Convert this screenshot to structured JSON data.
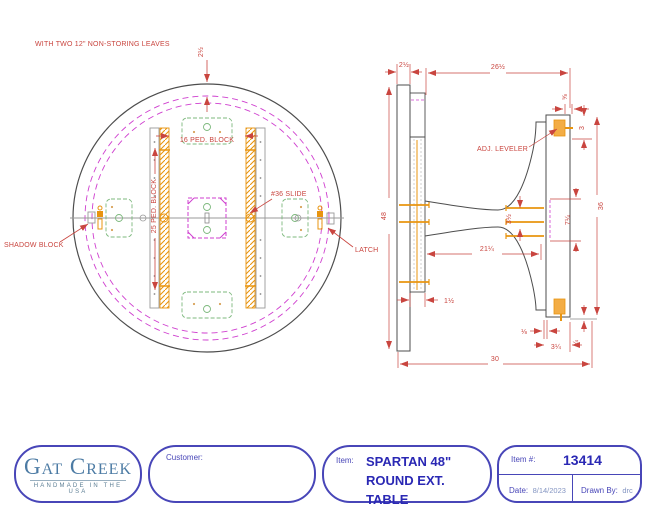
{
  "plan": {
    "note": "WITH TWO 12\" NON-STORING LEAVES",
    "dim_edge": "2½",
    "label_ped16": "16 PED. BLOCK",
    "label_ped25": "25 PED. BLOCK",
    "label_slide": "#36 SLIDE",
    "label_shadow": "SHADOW BLOCK",
    "label_latch": "LATCH"
  },
  "side": {
    "label_leveler": "ADJ. LEVELER",
    "dim_top_thickness": "2½",
    "dim_underside": "26½",
    "dim_diameter": "48",
    "dim_height": "30",
    "dim_slide": "21¼",
    "dim_band": "1½",
    "dim_neck": "3½",
    "dim_hub": "7¼",
    "dim_spread": "36",
    "dim_tip": "3",
    "dim_lip": "⅝",
    "dim_gap": "⅛",
    "dim_foot_end": "3¼",
    "dim_leveler_adj": "¼"
  },
  "title_block": {
    "logo_name": "Gat Creek",
    "logo_tagline": "HANDMADE IN THE USA",
    "customer_label": "Customer:",
    "item_label": "Item:",
    "item_line1": "SPARTAN 48\"",
    "item_line2": "ROUND EXT. TABLE",
    "item_no_label": "Item #:",
    "item_no": "13414",
    "date_label": "Date:",
    "date_value": "8/14/2023",
    "drawn_label": "Drawn By:",
    "drawn_value": "drc"
  },
  "colors": {
    "dimension_red": "#c9453f",
    "hardware_orange": "#e8940f",
    "block_green": "#7cb87c",
    "leaf_magenta": "#cf3fcf",
    "border_blue": "#4846b8",
    "logo_teal": "#4c7ba4"
  }
}
